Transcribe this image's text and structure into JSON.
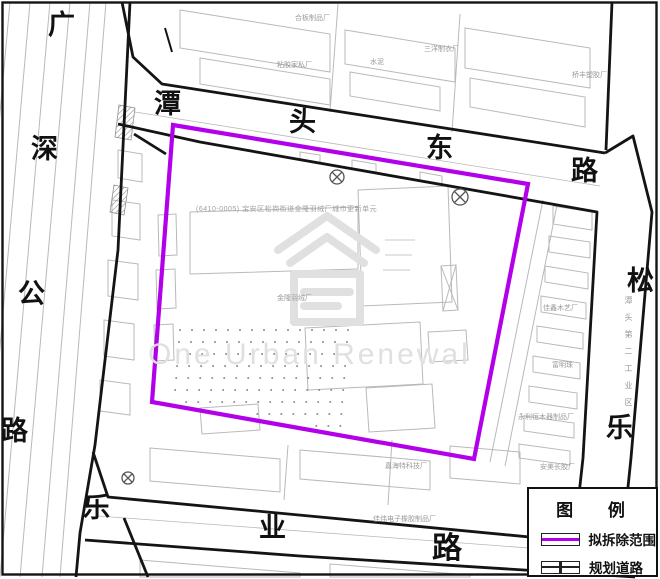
{
  "roads": {
    "top": [
      "潭",
      "头",
      "东",
      "路"
    ],
    "left": [
      "广",
      "深",
      "公",
      "路"
    ],
    "right": [
      "松",
      "乐"
    ],
    "bottom": [
      "乐",
      "业",
      "路"
    ]
  },
  "renewal_unit_label": "(6410-0005) 宝安区松岗街道金隆羽绒厂城市更新单元",
  "site_labels": {
    "plywood_factory": "合板制品厂",
    "furniture_factory": "粘胶家私厂",
    "cement": "水泥",
    "garment_factory": "三洋制衣厂",
    "plastics_factory": "桥丰塑胶厂",
    "down_factory": "金隆羽绒厂",
    "tech_factory": "嘉海特科技厂",
    "rubber_factory": "佳伟电子橡胶制品厂",
    "glue_factory": "安美长胶厂",
    "woodcraft_factory": "佳鑫木艺厂",
    "pearl_factory": "富明珠",
    "woodware_factory": "永利恒木器制品厂",
    "industrial_zone": "潭头第二工业区"
  },
  "watermark": {
    "text": "One Urban Renewal"
  },
  "legend": {
    "title": "图 例",
    "items": [
      {
        "symbol": "demolition-extent",
        "label": "拟拆除范围"
      },
      {
        "symbol": "planned-road",
        "label": "规划道路"
      }
    ]
  },
  "colors": {
    "demolition": "#B300EA",
    "road-outline": "#141414",
    "parcel": "#b9b9b9",
    "label-gray": "#9a9a9a",
    "watermark": "#e0e0e0"
  }
}
